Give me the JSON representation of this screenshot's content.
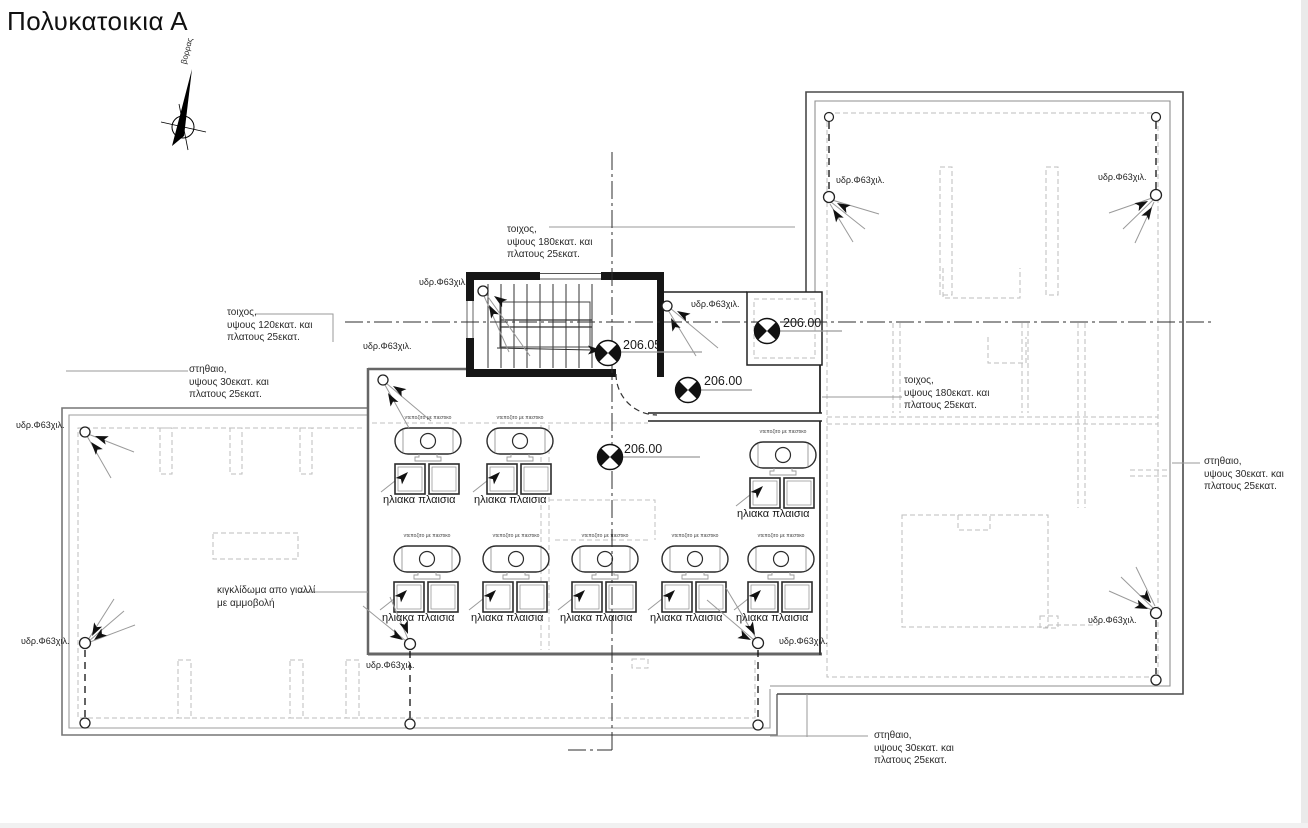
{
  "drawing": {
    "title": "Πολυκατοικια Α",
    "north_label": "βορρας"
  },
  "levels": {
    "stair_landing": "206.05",
    "roof": "206.00"
  },
  "callouts": {
    "hydro": "υδρ.Φ63χιλ.",
    "tank": "ντεποζιτο με πιεστικο",
    "solar_panels": "ηλιακα πλαισια",
    "wall_180": "τοιχος,\nυψους 180εκατ. και\nπλατους 25εκατ.",
    "wall_120": "τοιχος,\nυψους 120εκατ. και\nπλατους 25εκατ.",
    "parapet_30": "στηθαιο,\nυψους 30εκατ. και\nπλατους 25εκατ.",
    "glass_railing": "κιγκλίδωμα απο γιαλλί\nμε αμμοβολή"
  }
}
